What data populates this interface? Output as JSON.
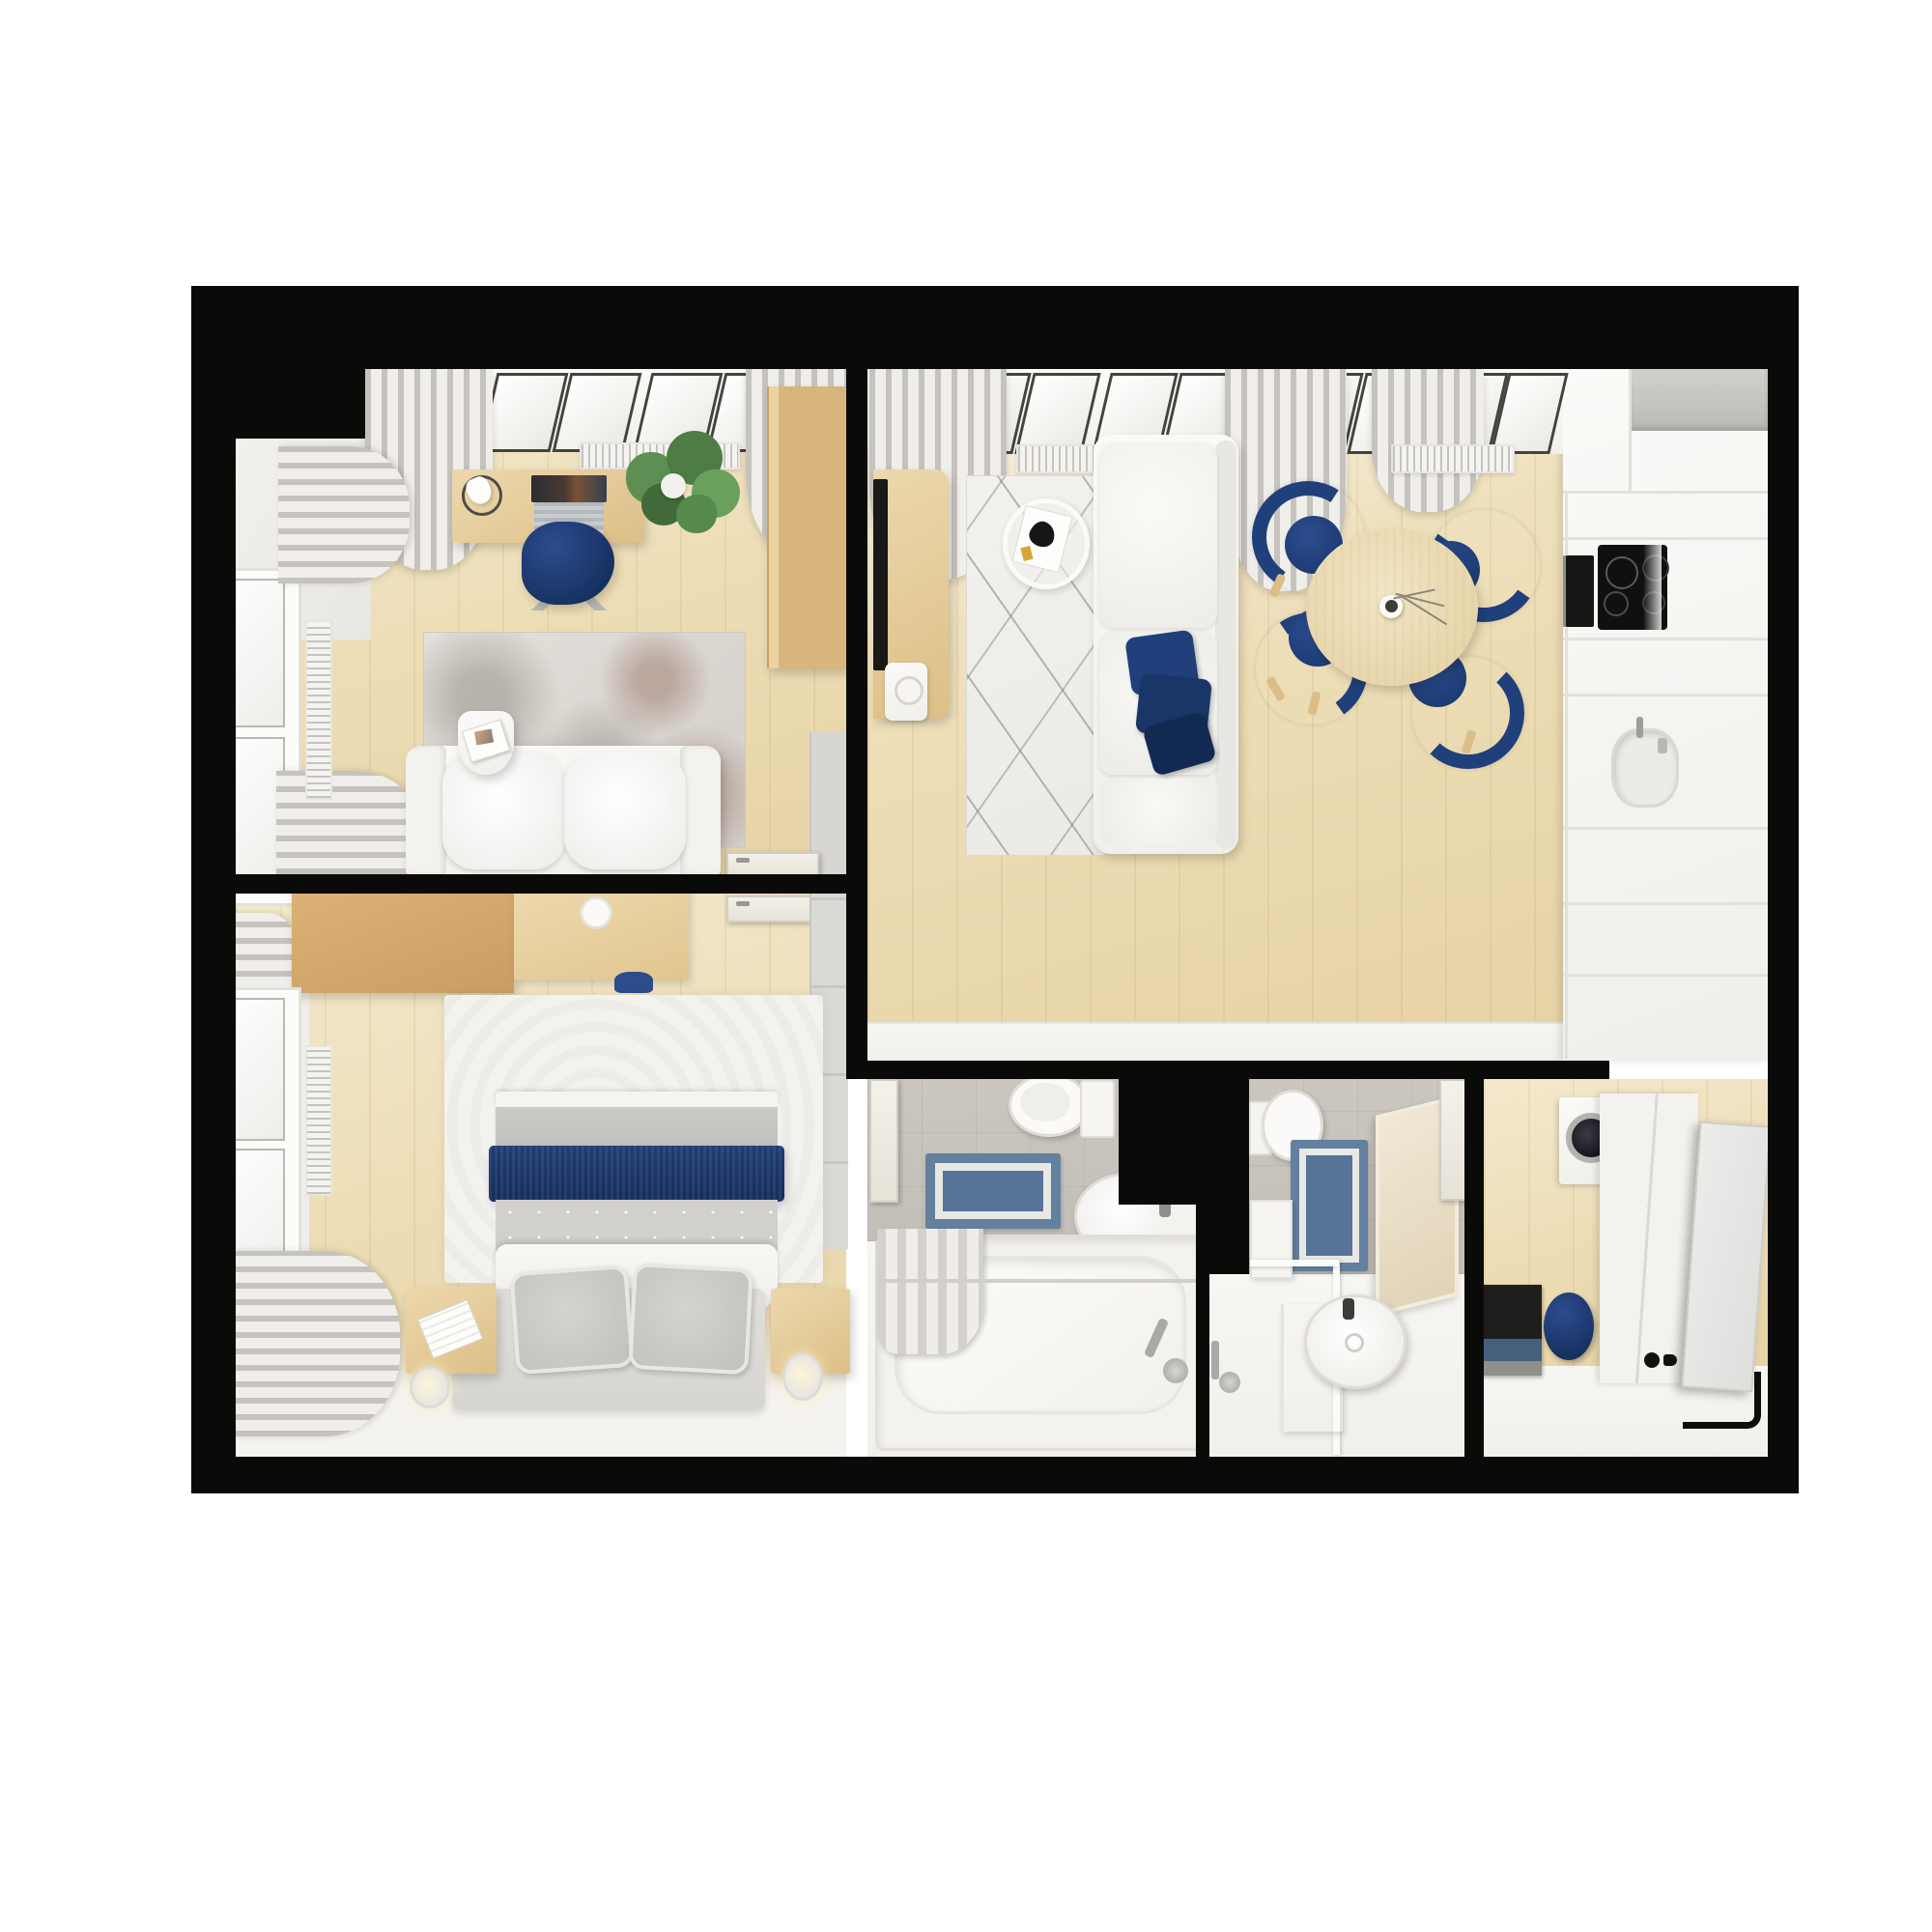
{
  "title": "Top-down 3D render of a one-bedroom apartment floor plan",
  "palette": {
    "wall": "#0a0a09",
    "floor_wood": "#ecdcb4",
    "floor_white": "#f5f4f1",
    "floor_tile": "#c8c4be",
    "accent_navy": "#1d3869",
    "furniture_wood": "#dcba84",
    "curtain_gray": "#d9d6d1",
    "bath_rug_blue": "#5f7ca1",
    "plant_green": "#558a4b"
  },
  "rooms": [
    {
      "id": "office",
      "label": "Office",
      "furniture": [
        "skylight windows",
        "curtains",
        "radiators",
        "desk",
        "desk lamp",
        "laptop",
        "navy office chair",
        "potted plant",
        "wooden wardrobe",
        "distressed gray rug",
        "white sofa",
        "side table with magazines",
        "door"
      ]
    },
    {
      "id": "bedroom",
      "label": "Bedroom",
      "furniture": [
        "window",
        "curtains",
        "radiator",
        "wooden vanity desk",
        "stool",
        "double bed",
        "navy blanket",
        "gray pillows",
        "white rug",
        "two nightstands",
        "reading lamps",
        "gray wardrobe",
        "door"
      ]
    },
    {
      "id": "living-room",
      "label": "Living room with kitchen",
      "furniture": [
        "skylight windows",
        "curtains",
        "radiators",
        "TV cabinet",
        "TV",
        "white patterned rug",
        "round coffee table",
        "white corner sofa",
        "navy cushions",
        "round dining table",
        "vase with twigs",
        "four navy dining chairs",
        "kitchen cabinet run",
        "cooker hood",
        "oven",
        "induction hob",
        "kitchen sink"
      ]
    },
    {
      "id": "bathroom",
      "label": "Bathroom",
      "furniture": [
        "door",
        "toilet",
        "blue bath mat",
        "washbasin",
        "bathtub",
        "shower curtain",
        "bath fittings"
      ]
    },
    {
      "id": "shower-room",
      "label": "Shower room",
      "furniture": [
        "toilet",
        "blue bath mat",
        "cabinet",
        "mirror",
        "shower enclosure",
        "towel radiator",
        "round washbasin",
        "door"
      ]
    },
    {
      "id": "hallway",
      "label": "Entrance hall",
      "furniture": [
        "washing machine",
        "white wardrobe",
        "open entrance door",
        "door threshold",
        "doormat",
        "navy pouf"
      ]
    }
  ]
}
